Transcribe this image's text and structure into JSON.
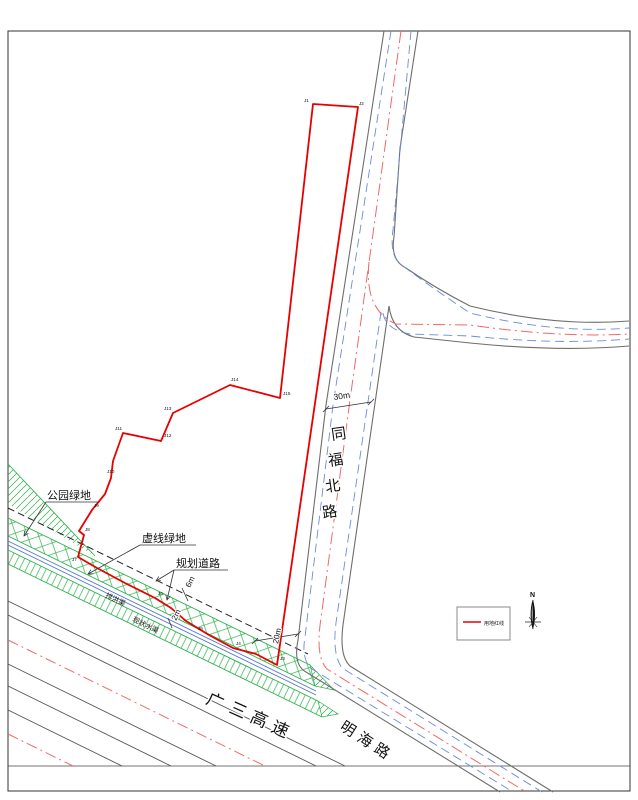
{
  "roads": {
    "tongfu": {
      "name": "同福北路",
      "chars": [
        "同",
        "福",
        "北",
        "路"
      ]
    },
    "expressway": {
      "name": "广三高速",
      "chars": [
        "广",
        "三",
        "高",
        "速"
      ]
    },
    "minghai": {
      "name": "明海路",
      "chars": [
        "明",
        "海",
        "路"
      ]
    }
  },
  "annotations": {
    "park_green": "公园绿地",
    "dashed_green": "虚线绿地",
    "planned_road": "规划道路",
    "channel_a": "排洪渠",
    "channel_b": "现状水渠"
  },
  "dimensions": {
    "road_width": "30m",
    "planned_road_width": "6m",
    "channel_width": "2m",
    "setback": "20m"
  },
  "legend": {
    "red_line_label": "用地红线"
  },
  "compass": {
    "north": "N"
  },
  "boundary": {
    "name": "用地红线",
    "vertices": [
      "J1",
      "J2",
      "J3",
      "J4",
      "J5",
      "J6",
      "J7",
      "J8",
      "J9",
      "J10",
      "J11",
      "J12",
      "J13",
      "J14",
      "J15"
    ]
  },
  "colors": {
    "boundary_red": "#e80000",
    "centerline_red": "#f06a6a",
    "road_gray": "#6e6e6e",
    "road_blue": "#6b8bdd",
    "green": "#2cb24a",
    "dashed_black": "#222222"
  }
}
